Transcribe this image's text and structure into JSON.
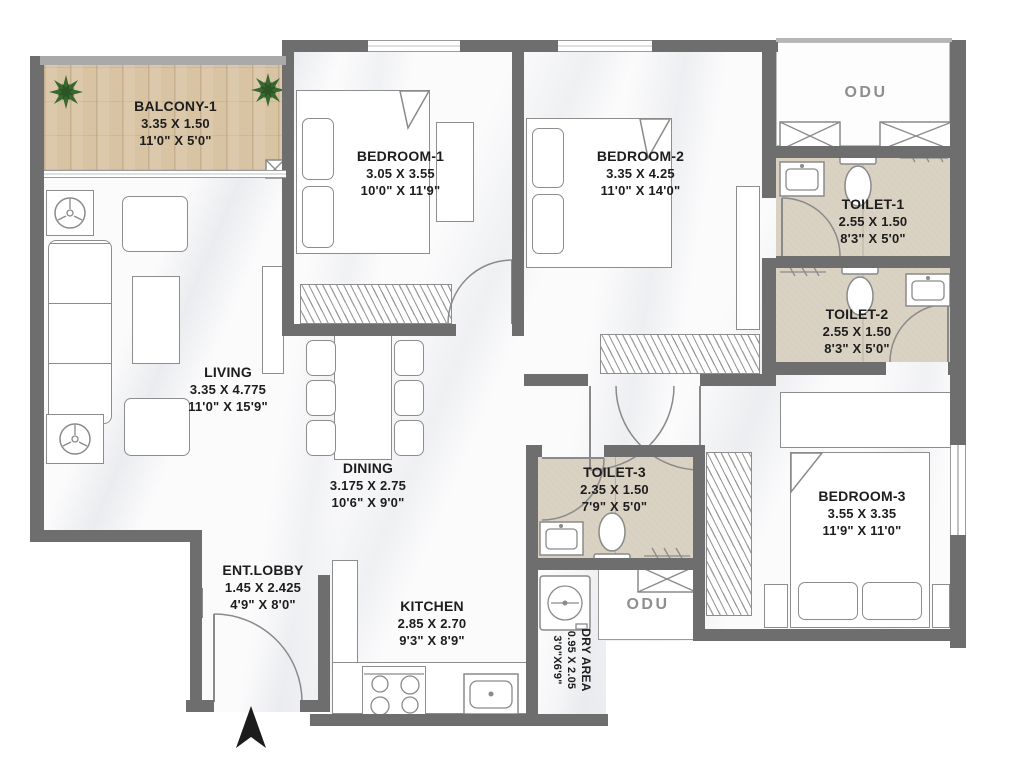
{
  "plan": {
    "rooms": [
      {
        "name": "BALCONY-1",
        "dim_m": "3.35 X 1.50",
        "dim_ft": "11'0\" X 5'0\""
      },
      {
        "name": "BEDROOM-1",
        "dim_m": "3.05 X 3.55",
        "dim_ft": "10'0\" X 11'9\""
      },
      {
        "name": "BEDROOM-2",
        "dim_m": "3.35 X 4.25",
        "dim_ft": "11'0\" X 14'0\""
      },
      {
        "name": "TOILET-1",
        "dim_m": "2.55 X 1.50",
        "dim_ft": "8'3\" X 5'0\""
      },
      {
        "name": "TOILET-2",
        "dim_m": "2.55 X 1.50",
        "dim_ft": "8'3\" X 5'0\""
      },
      {
        "name": "LIVING",
        "dim_m": "3.35 X 4.775",
        "dim_ft": "11'0\" X 15'9\""
      },
      {
        "name": "DINING",
        "dim_m": "3.175 X 2.75",
        "dim_ft": "10'6\" X 9'0\""
      },
      {
        "name": "ENT.LOBBY",
        "dim_m": "1.45 X 2.425",
        "dim_ft": "4'9\" X 8'0\""
      },
      {
        "name": "KITCHEN",
        "dim_m": "2.85 X 2.70",
        "dim_ft": "9'3\" X 8'9\""
      },
      {
        "name": "TOILET-3",
        "dim_m": "2.35 X 1.50",
        "dim_ft": "7'9\" X 5'0\""
      },
      {
        "name": "BEDROOM-3",
        "dim_m": "3.55 X 3.35",
        "dim_ft": "11'9\" X 11'0\""
      },
      {
        "name": "DRY AREA",
        "dim_m": "0.95 X 2.05",
        "dim_ft": "3'0\"X6'9\""
      }
    ],
    "odu_label": "ODU",
    "colors": {
      "wall": "#6e6e6e",
      "balcony_wood": "#d8c3a2",
      "toilet_tile": "#d8d0c0",
      "label_text": "#1d1d1d",
      "odu_text": "#8e8e8e",
      "plant_green": "#38682f"
    }
  }
}
